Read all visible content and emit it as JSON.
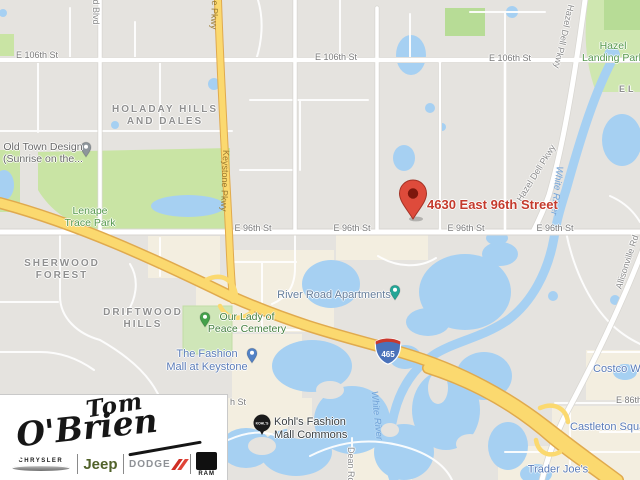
{
  "map": {
    "address_marker": "4630 East 96th Street",
    "interstate_shield": "465",
    "kohls_icon_text": "KOHL'S",
    "labels": [
      {
        "text": "E 106th St"
      },
      {
        "text": "E 106th St"
      },
      {
        "text": "E 106th St"
      },
      {
        "text": "E 96th St"
      },
      {
        "text": "E 96th St"
      },
      {
        "text": "E 96th St"
      },
      {
        "text": "E 96th St"
      },
      {
        "text": "h St"
      },
      {
        "text": "E 86th St"
      },
      {
        "text": "Keystone Pkwy"
      },
      {
        "text": "Keystone Pkwy"
      },
      {
        "text": "field Blvd"
      },
      {
        "text": "Hazel Dell Pkwy"
      },
      {
        "text": "Hazel Dell Pkwy"
      },
      {
        "text": "Allisonville Rd"
      },
      {
        "text": "Dean Rd"
      },
      {
        "text": "HOLADAY HILLS",
        "text2": "AND DALES"
      },
      {
        "text": "SHERWOOD",
        "text2": "FOREST"
      },
      {
        "text": "DRIFTWOOD",
        "text2": "HILLS"
      },
      {
        "text": "EL"
      },
      {
        "text": "Hazel",
        "text2": "Landing Park"
      },
      {
        "text": "Lenape",
        "text2": "Trace Park"
      },
      {
        "text": "Old Town Design",
        "text2": "(Sunrise on the..."
      },
      {
        "text": "Our Lady of",
        "text2": "Peace Cemetery"
      },
      {
        "text": "The Fashion",
        "text2": "Mall at Keystone"
      },
      {
        "text": "River Road Apartments"
      },
      {
        "text": "Kohl's Fashion",
        "text2": "Mall Commons"
      },
      {
        "text": "Costco Wholesale"
      },
      {
        "text": "Castleton Square"
      },
      {
        "text": "Trader Joe's"
      },
      {
        "text": "White River"
      },
      {
        "text": "White River"
      }
    ]
  },
  "logo": {
    "name_line1": "Tom",
    "name_line2": "O'Brien",
    "brands": [
      "CHRYSLER",
      "Jeep",
      "DODGE",
      "RAM"
    ]
  },
  "colors": {
    "marker_red": "#de4b3b",
    "address_text_red": "#c43a2c",
    "highway_yellow": "#fbd96f",
    "water_blue": "#a6d0f2",
    "park_green": "#c9e4a4",
    "shopping_label_blue": "#5b7cb8",
    "interstate_shield_blue": "#4a72ba"
  },
  "icons": {
    "marker": "red-map-pin",
    "poi_pins": "small-teardrop-pin",
    "kohls": "black-circle-logo",
    "interstate": "interstate-shield-465"
  }
}
